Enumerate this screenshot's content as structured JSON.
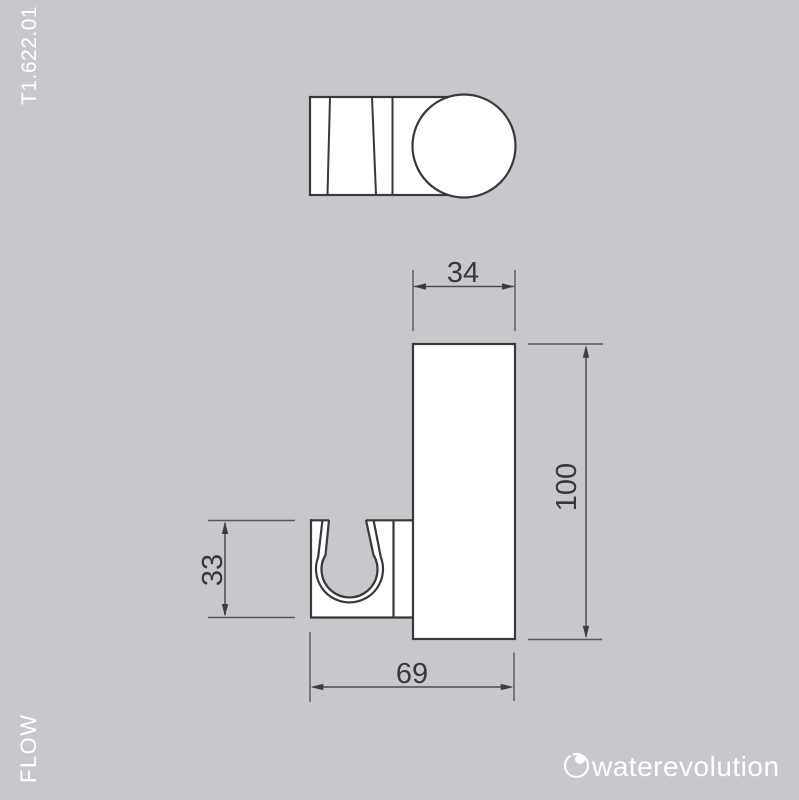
{
  "meta": {
    "background_color": "#c6c8cb",
    "object_line_color": "#38393b",
    "dimension_line_color": "#4a4c4e",
    "dimension_text_color": "#37383a",
    "label_text_color": "#ffffff"
  },
  "margin_labels": {
    "product_code": "T1.622.01",
    "series_name": "FLOW"
  },
  "brand": {
    "logo_text": "waterevolution",
    "logo_icon": "water-drop-circle-icon"
  },
  "dimensions": {
    "plate_width": "34",
    "plate_height": "100",
    "clip_height": "33",
    "total_depth": "69"
  }
}
